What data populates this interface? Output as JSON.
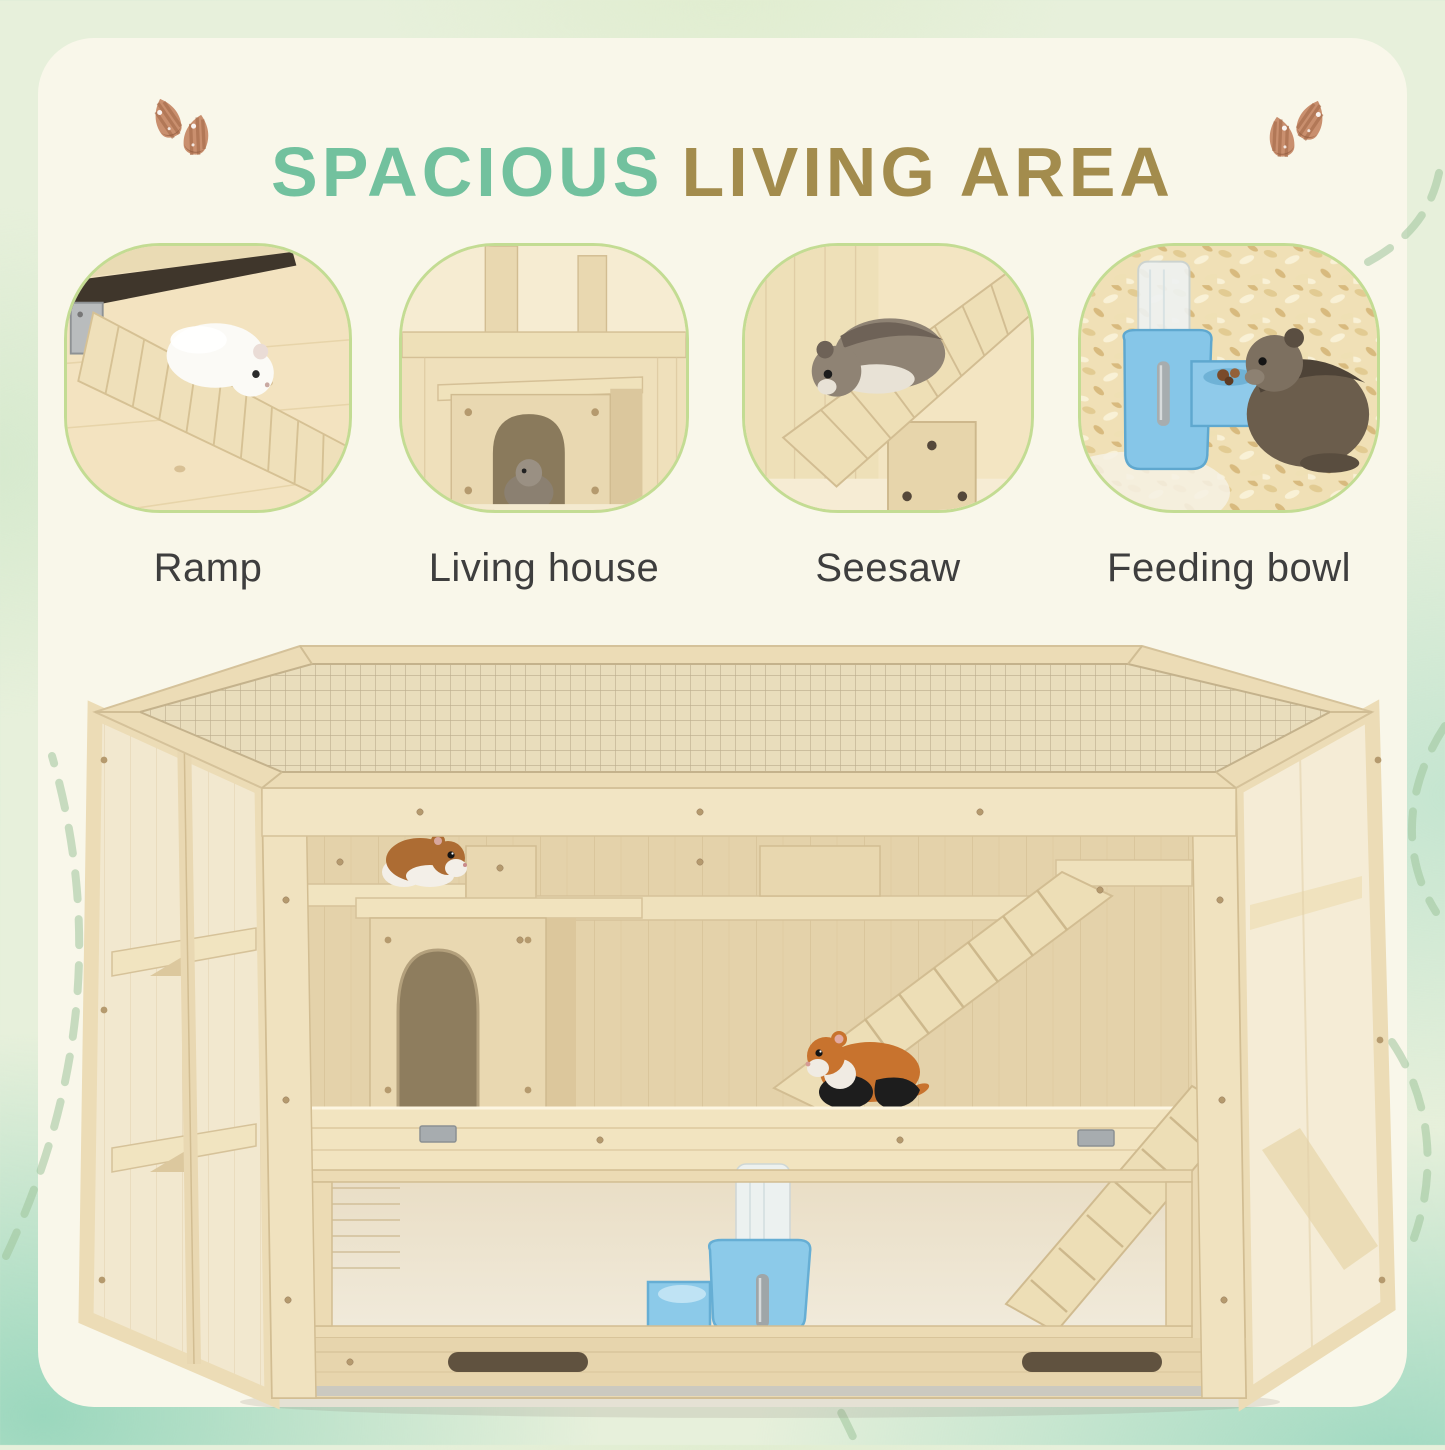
{
  "header": {
    "title_part1": "SPACIOUS",
    "title_part2": "LIVING AREA",
    "title_part1_color": "#72c19e",
    "title_part2_color": "#a38c4d",
    "almond_icon_color": "#c98f6e"
  },
  "features": [
    {
      "label": "Ramp",
      "image": "hamster-on-wooden-ramp-photo"
    },
    {
      "label": "Living house",
      "image": "hamster-in-wooden-house-photo"
    },
    {
      "label": "Seesaw",
      "image": "hamster-on-seesaw-photo"
    },
    {
      "label": "Feeding bowl",
      "image": "hamster-at-feeding-bowl-photo"
    }
  ],
  "product_image": {
    "subject": "hexagonal multi-level wooden hamster cage with wire mesh top, side shelves, arched living house, ramps, cartoon hamsters and blue water feeder"
  },
  "style": {
    "background_color": "#e7f0db",
    "panel_color": "#f9f7ea",
    "card_border_color": "#c3dc93",
    "label_color": "#3e3e3e",
    "dashed_line_color": "#9fc49a",
    "wood_color": "#e9d8b2",
    "mesh_color": "#e9ddbc",
    "feeder_blue": "#8ccae9"
  }
}
